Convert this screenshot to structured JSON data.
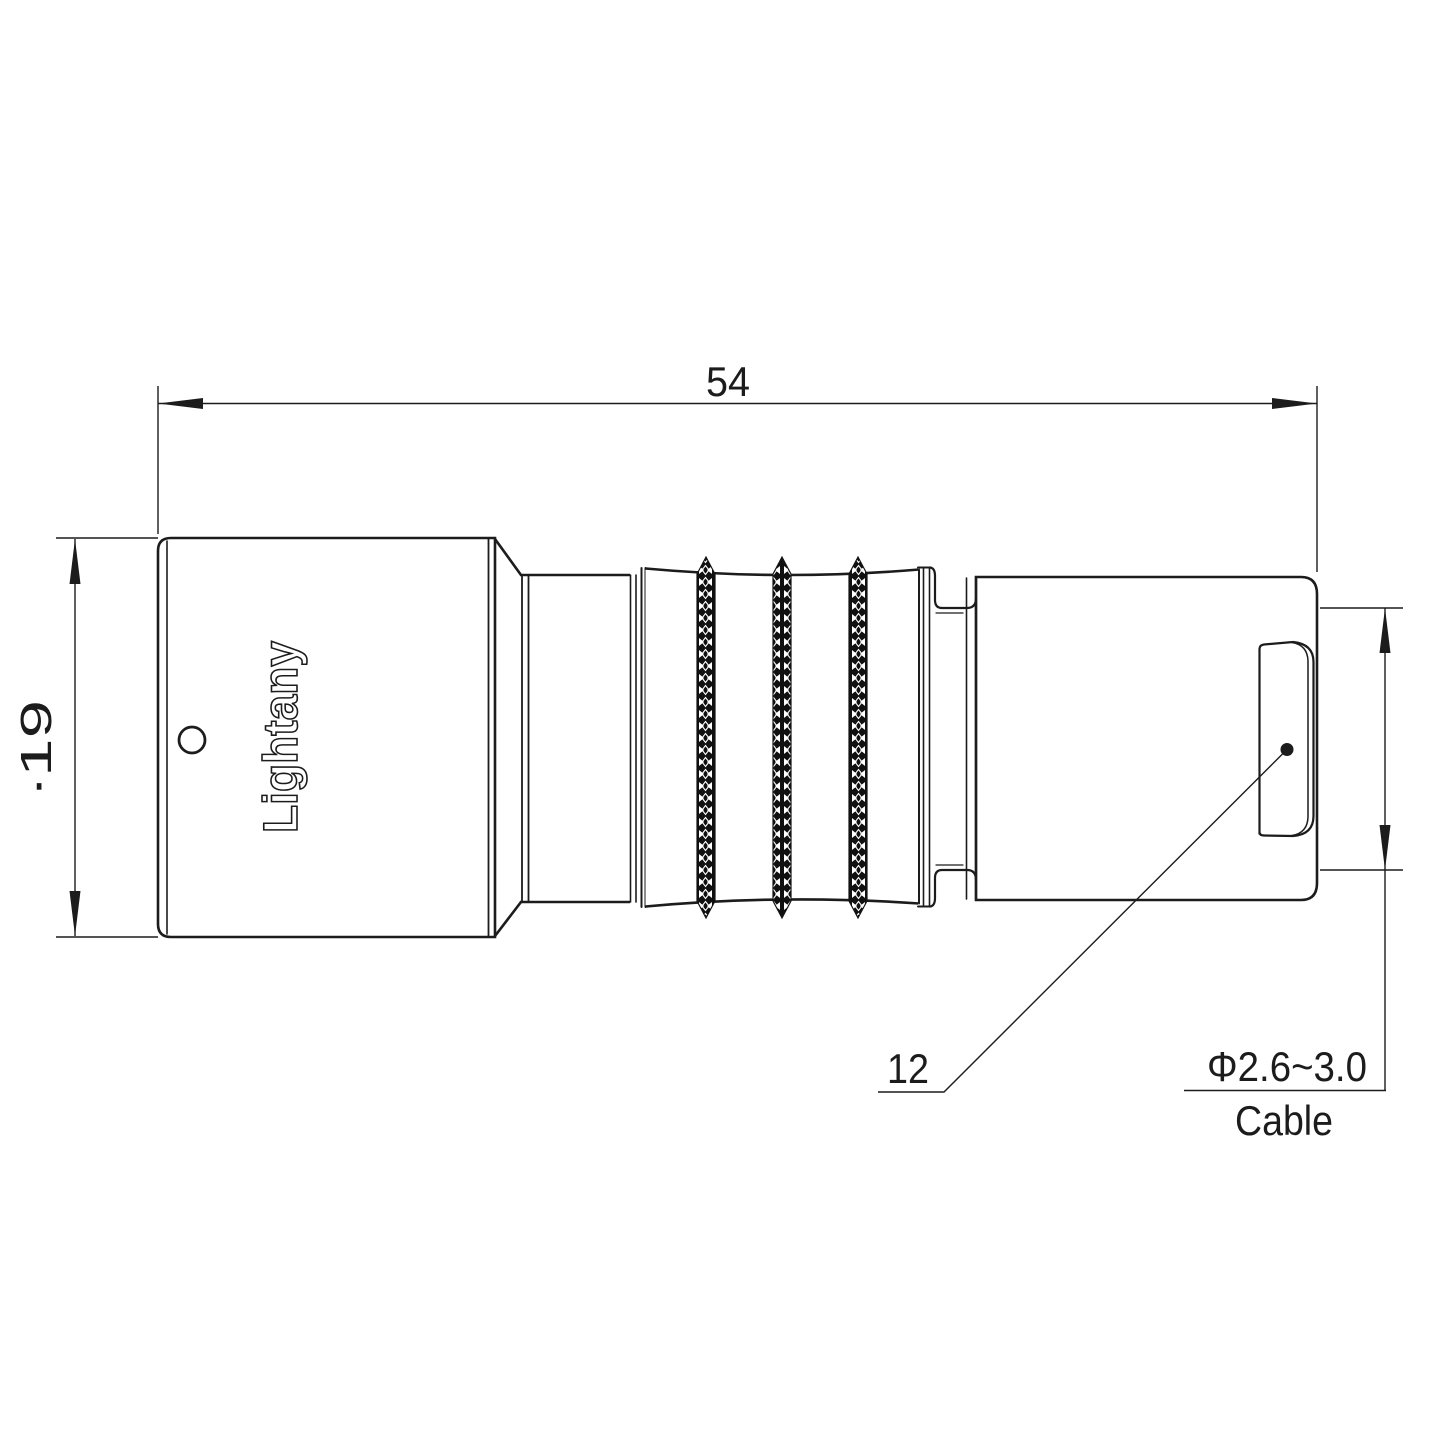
{
  "drawing": {
    "watermark": "Lightany",
    "shell_logo": "Lightany",
    "dimensions": {
      "overall_length": "54",
      "front_diameter": "∙19",
      "bushing_size": "12",
      "cable_diameter": "Φ2.6~3.0",
      "cable_label": "Cable"
    },
    "colors": {
      "line": "#1c1c1c",
      "watermark_pink": "#f3bfbf"
    }
  }
}
